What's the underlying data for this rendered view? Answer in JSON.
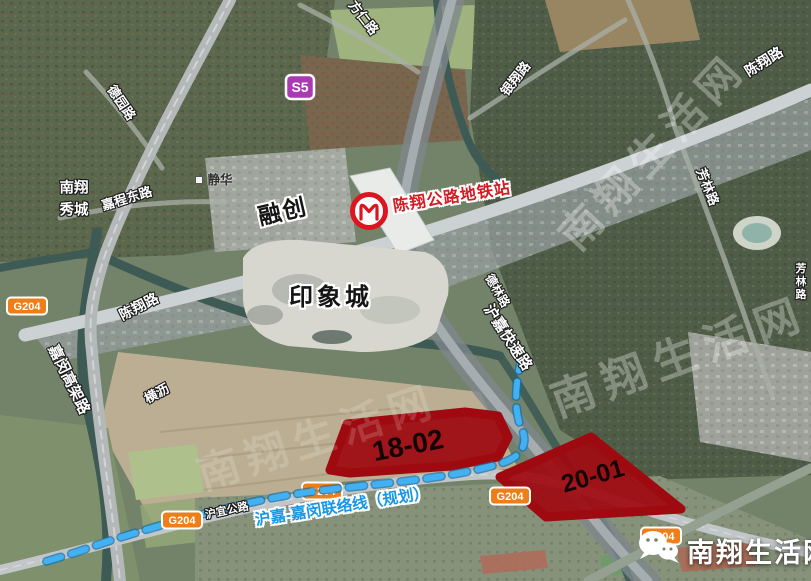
{
  "colors": {
    "parcel_red": "#9e0a10",
    "planned_line_blue": "#36a9ec",
    "station_label_red": "#d51a22",
    "badge_orange": "#ee7f18",
    "badge_purple": "#a93ab2",
    "metro_logo_red": "#dc1620"
  },
  "labels": {
    "watermark": "南翔生活网",
    "site_name": "南翔生活网",
    "station_name": "陈翔公路地铁站",
    "mall": "印象城",
    "developer": "融创",
    "parcel_a": "18-02",
    "parcel_b": "20-01",
    "planned_line": "沪嘉-嘉闵联络线（规划）",
    "badge_s5": "S5",
    "badge_g204": "G204",
    "road_fangren": "方仁路",
    "road_yinxiang": "银翔路",
    "road_chenxiang": "陈翔路",
    "road_fanglin": "芳林路",
    "road_deyuan": "德园路",
    "place_nanxiang_line1": "南翔",
    "place_nanxiang_line2": "秀城",
    "road_jiacheng_east": "嘉程东路",
    "place_jinghua": "静华",
    "road_jiamin_viaduct": "嘉闵高架路",
    "river_hengli": "横沥",
    "road_hujia_expwy": "沪嘉快速路",
    "road_delin": "德林路",
    "road_huyi": "沪宜公路"
  }
}
